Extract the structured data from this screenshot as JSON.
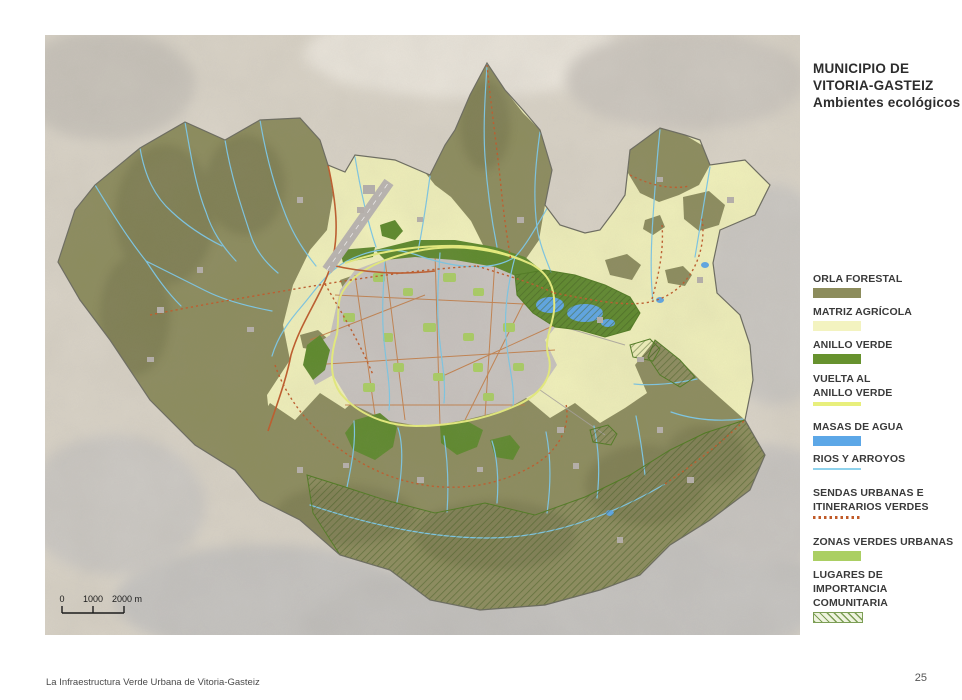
{
  "header": {
    "title_line1": "MUNICIPIO DE",
    "title_line2": "VITORIA-GASTEIZ",
    "subtitle": "Ambientes ecológicos"
  },
  "legend": {
    "items": [
      {
        "label": "ORLA FORESTAL",
        "color": "#8C8C5C",
        "swatch": "fill"
      },
      {
        "label": "MATRIZ AGRÍCOLA",
        "color": "#F3F3C0",
        "swatch": "fill"
      },
      {
        "label": "ANILLO VERDE",
        "color": "#67922E",
        "swatch": "fill"
      },
      {
        "label": "VUELTA AL",
        "label2": "ANILLO VERDE",
        "color": "#E8EF7C",
        "swatch": "line"
      },
      {
        "label": "MASAS DE AGUA",
        "color": "#5CA7E7",
        "swatch": "fill"
      },
      {
        "label": "RIOS Y ARROYOS",
        "color": "#8ED2EC",
        "swatch": "thinline"
      },
      {
        "label": "SENDAS URBANAS E",
        "label2": "ITINERARIOS VERDES",
        "color": "#C05A28",
        "swatch": "dotted"
      },
      {
        "label": "ZONAS VERDES URBANAS",
        "color": "#ABCF63",
        "swatch": "fill"
      },
      {
        "label": "LUGARES DE",
        "label2": "IMPORTANCIA COMUNITARIA",
        "color": "#7C9E55",
        "swatch": "hatch"
      }
    ]
  },
  "map": {
    "scale_labels": {
      "zero": "0",
      "mid": "1000",
      "end": "2000 m"
    },
    "colors": {
      "terrain": "#DAD4C8",
      "outside_hills": "#C6C3BF",
      "forest": "#8C8C5C",
      "agricultural_matrix": "#F2F2BB",
      "green_ring": "#5D892B",
      "urban": "#C9C4C0",
      "urban_green": "#ABCF63",
      "water": "#5CA7E7",
      "river": "#7CC9E8",
      "route": "#C05A28",
      "ring_line": "#E8EF7C",
      "boundary": "#6A6A5E"
    }
  },
  "footer": {
    "caption": "La Infraestructura Verde Urbana de Vitoria-Gasteiz",
    "page_number": "25"
  }
}
